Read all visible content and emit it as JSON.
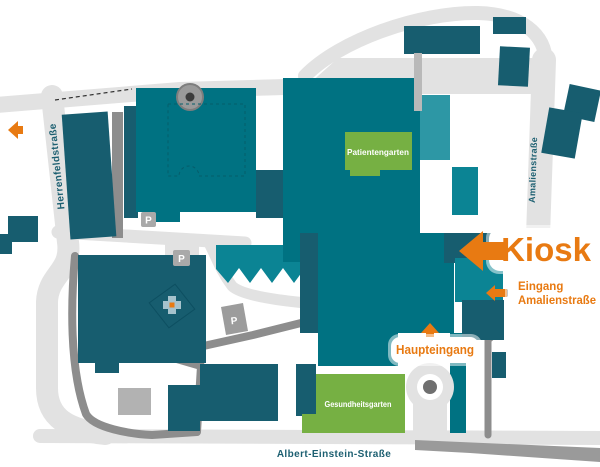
{
  "map": {
    "type": "hospital-campus-site-map",
    "colors": {
      "building_dark": "#175d6f",
      "building_mid": "#007282",
      "building_mid2": "#0b8494",
      "building_light": "#2d97a5",
      "garden_green": "#76b043",
      "road_light": "#e2e2e2",
      "road_dark": "#8d8d8d",
      "accent_orange": "#e87a12",
      "street_label_teal": "#1c5f71"
    },
    "streets": {
      "herrenfeldstrasse": "Herrenfeldstraße",
      "amalienstrasse": "Amalienstraße",
      "albert_einstein_strasse": "Albert-Einstein-Straße"
    },
    "gardens": {
      "patientengarten": "Patientengarten",
      "gesundheitsgarten": "Gesundheitsgarten"
    },
    "markers": {
      "kiosk": "Kiosk",
      "eingang_line1": "Eingang",
      "eingang_line2": "Amalienstraße",
      "haupteingang": "Haupteingang"
    },
    "parking_label": "P"
  }
}
